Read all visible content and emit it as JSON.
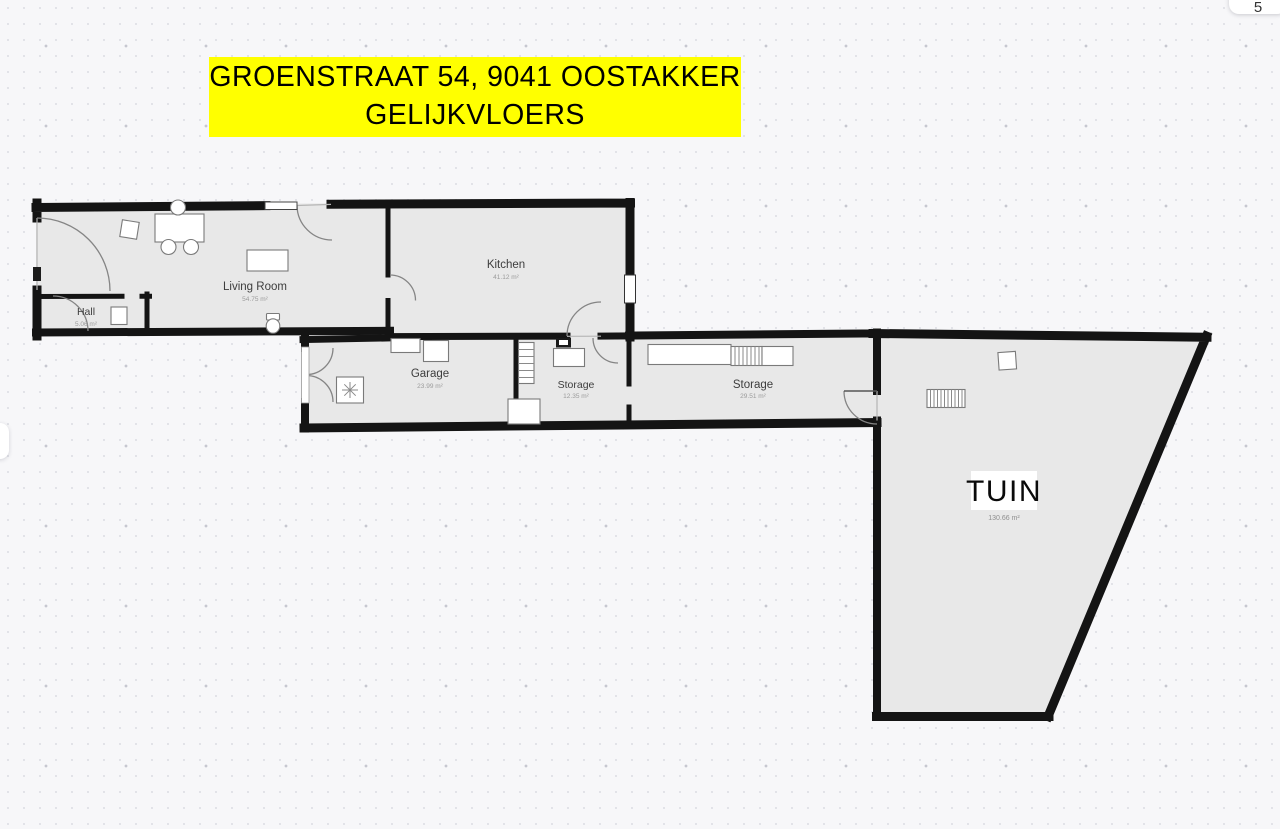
{
  "canvas": {
    "background_color": "#f7f7f9",
    "dot_grid_color": "#d7d8df",
    "floor_color": "#e8e8e8",
    "wall_color": "#141414"
  },
  "banner": {
    "line1": "GROENSTRAAT 54, 9041 OOSTAKKER",
    "line2": "GELIJKVLOERS",
    "background_color": "#ffff00",
    "text_color": "#000000"
  },
  "rooms": [
    {
      "name": "Hall",
      "area": "5.06 m²"
    },
    {
      "name": "Living Room",
      "area": "54.75 m²"
    },
    {
      "name": "Kitchen",
      "area": "41.12 m²"
    },
    {
      "name": "Garage",
      "area": "23.99 m²"
    },
    {
      "name": "Storage",
      "area": "12.35 m²"
    },
    {
      "name": "Storage",
      "area": "29.51 m²"
    },
    {
      "name": "TUIN",
      "area": "130.66 m²"
    }
  ],
  "ui": {
    "corner_button_glyph": "5"
  }
}
